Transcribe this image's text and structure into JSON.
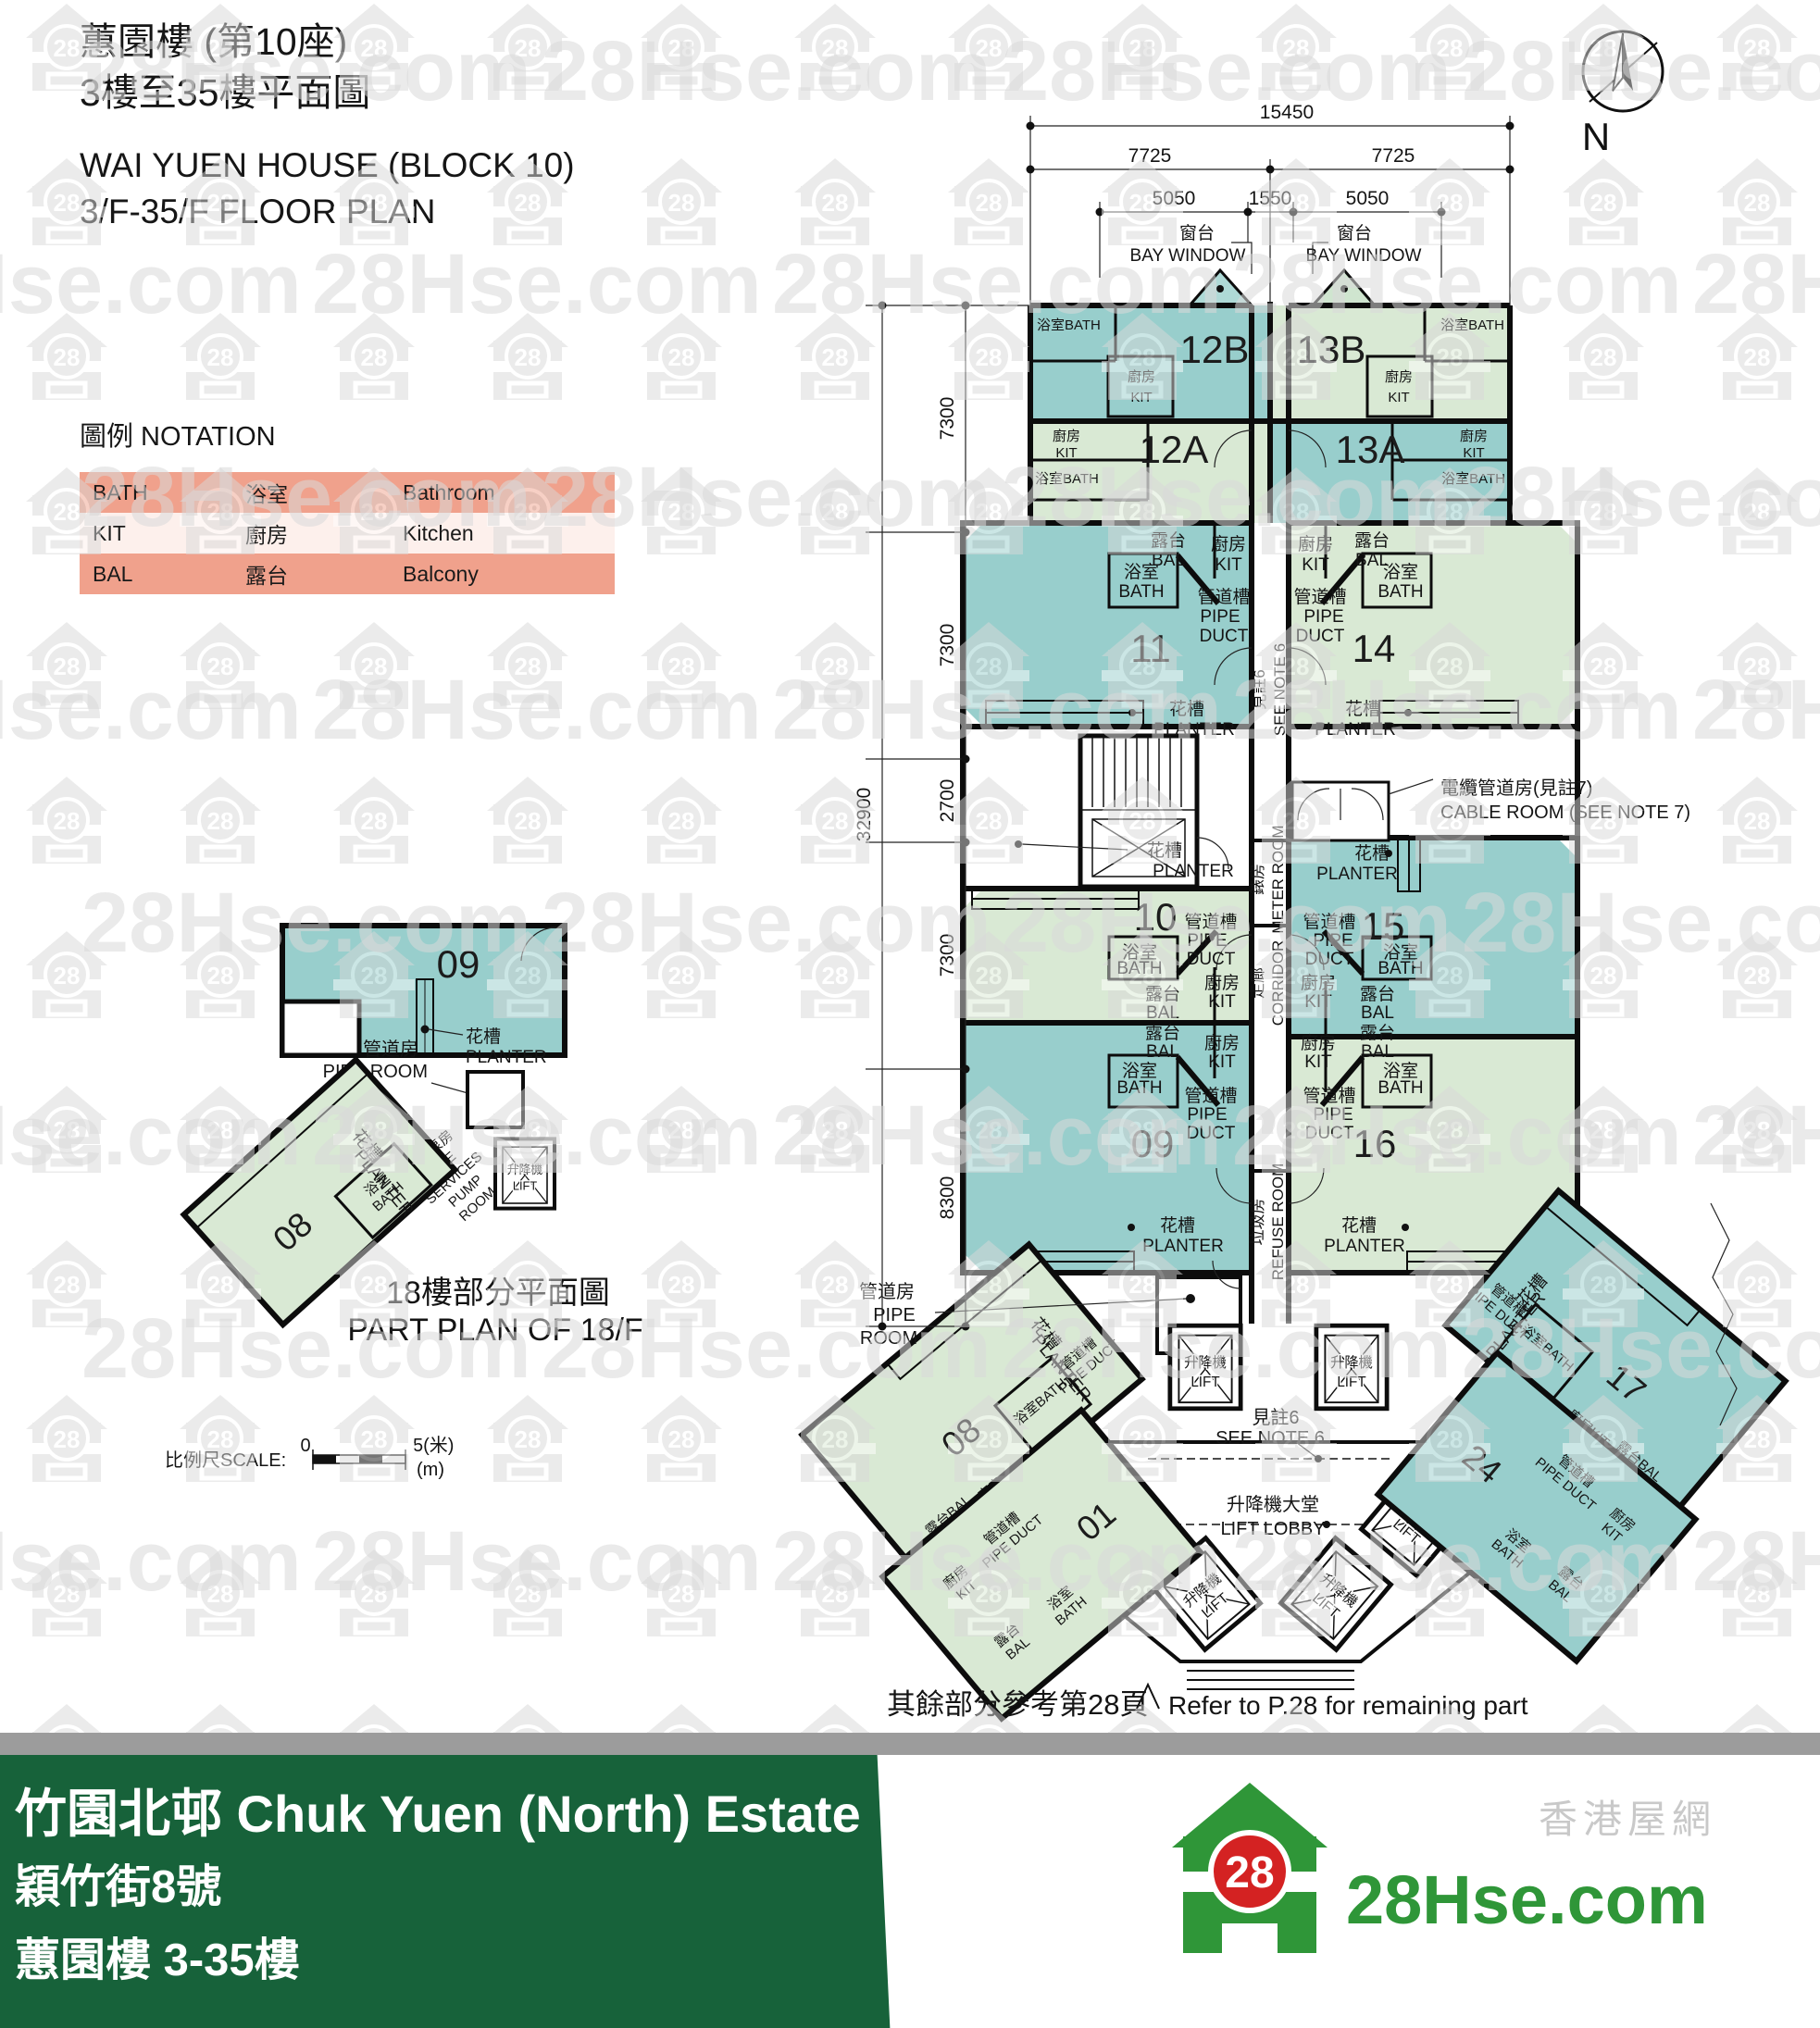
{
  "header": {
    "title_zh": "蕙園樓 (第10座)",
    "subtitle_zh": "3樓至35樓平面圖",
    "title_en": "WAI YUEN HOUSE (BLOCK 10)",
    "subtitle_en": "3/F-35/F FLOOR PLAN"
  },
  "notation": {
    "heading": "圖例 NOTATION",
    "rows": [
      {
        "code": "BATH",
        "zh": "浴室",
        "en": "Bathroom"
      },
      {
        "code": "KIT",
        "zh": "廚房",
        "en": "Kitchen"
      },
      {
        "code": "BAL",
        "zh": "露台",
        "en": "Balcony"
      }
    ]
  },
  "compass": {
    "label": "N"
  },
  "dims": {
    "total_w": "15450",
    "half_w": "7725",
    "bay": "5050",
    "gap": "1550",
    "total_h": "32900",
    "seg_a": "7300",
    "seg_b": "2700",
    "seg_c": "8300"
  },
  "labels": {
    "bath_zh": "浴室",
    "bath_en": "BATH",
    "bath_line": "浴室BATH",
    "kit_zh": "廚房",
    "kit_en": "KIT",
    "kit_line": "廚房KIT",
    "bal_zh": "露台",
    "bal_en": "BAL",
    "bal_line": "露台BAL",
    "duct_zh": "管道槽",
    "duct_en1": "PIPE",
    "duct_en2": "DUCT",
    "duct_line": "PIPE DUCT",
    "planter_zh": "花槽",
    "planter_en": "PLANTER",
    "piperoom_zh": "管道房",
    "piperoom_en": "PIPE ROOM",
    "piperoom_en1": "PIPE",
    "piperoom_en2": "ROOM",
    "cable_zh": "電纜管道房(見註7)",
    "cable_en": "CABLE ROOM (SEE NOTE 7)",
    "meter_zh": "錶房",
    "meter_en": "METER ROOM",
    "corridor_zh": "走廊",
    "corridor_en": "CORRIDOR",
    "refuse_zh": "垃圾房",
    "refuse_en": "REFUSE ROOM",
    "lift_zh": "升降機",
    "lift_en": "LIFT",
    "lobby_zh": "升降機大堂",
    "lobby_en": "LIFT LOBBY",
    "fire_zh": "消防泵房",
    "fire_en1": "FIRE",
    "fire_en2": "SERVICES",
    "fire_en3": "PUMP",
    "fire_en4": "ROOM",
    "note6_zh": "見註6",
    "note6_en": "SEE NOTE 6",
    "bay_zh": "窗台",
    "bay_en": "BAY WINDOW"
  },
  "units": {
    "u12b": "12B",
    "u13b": "13B",
    "u12a": "12A",
    "u13a": "13A",
    "u11": "11",
    "u14": "14",
    "u10": "10",
    "u15": "15",
    "u09": "09",
    "u16": "16",
    "u08": "08",
    "u17": "17",
    "u01": "01",
    "u24": "24"
  },
  "part_plan": {
    "caption_zh": "18樓部分平面圖",
    "caption_en": "PART PLAN OF 18/F",
    "u09": "09",
    "u08": "08"
  },
  "scalebar": {
    "label": "比例尺SCALE:",
    "zero": "0",
    "five": "5(米)",
    "m": "(m)"
  },
  "refer": {
    "zh": "其餘部分參考第28頁",
    "en": "Refer to P.28 for remaining part"
  },
  "banner": {
    "line1": "竹園北邨 Chuk Yuen (North) Estate",
    "line2": "穎竹街8號",
    "line3": "蕙園樓 3-35樓"
  },
  "logo": {
    "badge": "28",
    "brand": "28Hse.com",
    "tagline": "香港屋網"
  },
  "watermark": {
    "text": "28Hse.com",
    "badge": "28"
  },
  "colors": {
    "teal": "#98cecc",
    "green": "#d9e9d4",
    "salmon": "#f0a18c",
    "salmon_light": "#fdf0ec",
    "banner_green": "#17623a",
    "logo_green": "#2f9638",
    "logo_red": "#d42222"
  }
}
